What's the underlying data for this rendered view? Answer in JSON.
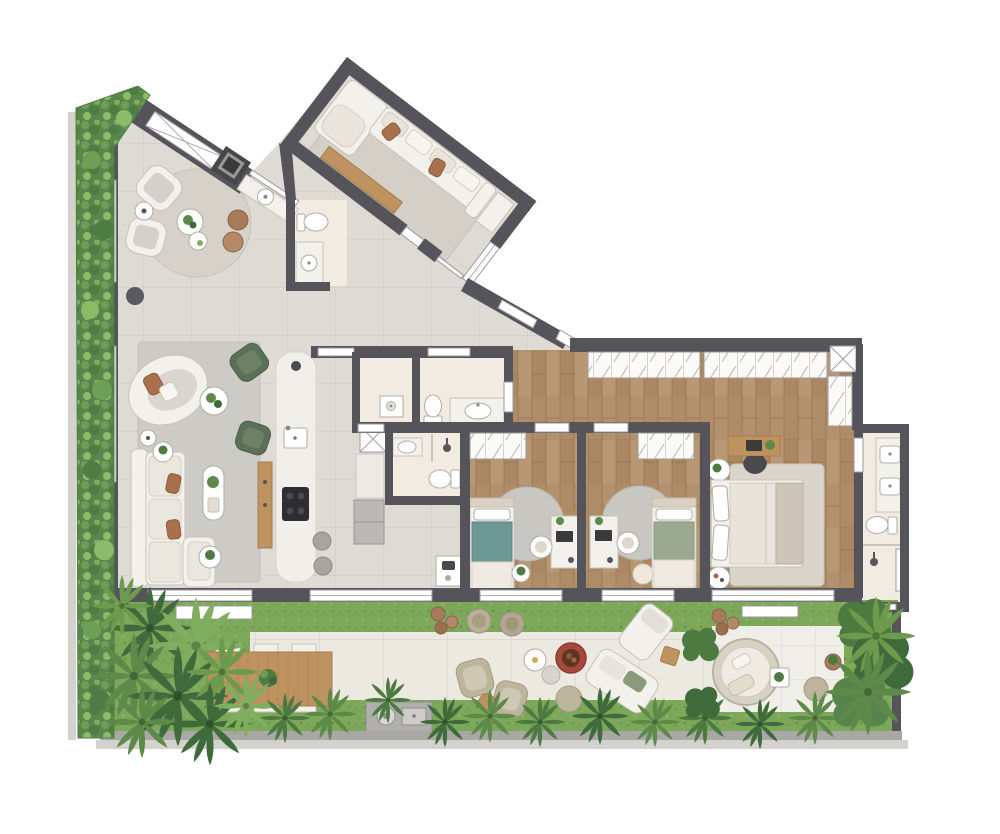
{
  "meta": {
    "type": "architectural-floor-plan",
    "style": "3d-rendered top-down marketing plan",
    "viewBox": "0 0 1000 834",
    "width": 1000,
    "height": 834
  },
  "colors": {
    "wall": "#55545a",
    "wallDark": "#45444a",
    "tile": "#dedbd4",
    "tileLine": "#ccc9c2",
    "wood": "#b3916e",
    "woodLine": "#9f7d58",
    "woodFurn": "#bf9360",
    "cream": "#f1ebe1",
    "furn": "#f3f1ec",
    "furnStroke": "#c8c3b9",
    "tan": "#bdb49c",
    "rugGray": "#cdcbc5",
    "rugBeige": "#d4d0c7",
    "greenChair": "#5c7058",
    "terracotta": "#b4643c",
    "teal": "#6e9894",
    "sage": "#9aa98f",
    "grass": "#7da85a",
    "grassDark": "#5e8a45",
    "paver": "#ece9e1",
    "paverLine": "#d9d5cb",
    "plantDark": "#3f6b3c",
    "plantMid": "#5d8a49",
    "plantLight": "#7fae5f",
    "hedge": "#59874b",
    "fire": "#a8473b",
    "steel": "#b0afac",
    "curb": "#d3d2ce",
    "curbDark": "#a9a8a5"
  },
  "rooms": [
    {
      "id": "entry-gallery",
      "furniture": [
        "pergola-skylight",
        "grill-station",
        "bar-sink"
      ]
    },
    {
      "id": "sitting-nook",
      "furniture": [
        "round-rug",
        "armchair",
        "armchair",
        "side-table",
        "nesting-tables",
        "pouf",
        "pouf",
        "floor-lamp"
      ]
    },
    {
      "id": "media-room",
      "furniture": [
        "sectional-sofa",
        "area-rug",
        "wood-console",
        "credenza"
      ]
    },
    {
      "id": "powder-room",
      "furniture": [
        "toilet",
        "vanity-sink"
      ]
    },
    {
      "id": "living-room",
      "furniture": [
        "curved-chaise",
        "l-sofa",
        "green-armchair",
        "green-armchair",
        "coffee-table",
        "oval-table",
        "side-table",
        "side-table",
        "floor-lamp",
        "wood-sideboard"
      ]
    },
    {
      "id": "kitchen",
      "furniture": [
        "island-counter",
        "cooktop",
        "island-sink",
        "stool",
        "stool",
        "tall-cabinet",
        "refrigerator",
        "service-shaft"
      ]
    },
    {
      "id": "laundry",
      "furniture": [
        "wash-tub"
      ]
    },
    {
      "id": "bathroom-1",
      "furniture": [
        "toilet",
        "vanity-sink"
      ]
    },
    {
      "id": "bathroom-2",
      "furniture": [
        "toilet",
        "vanity-sink",
        "shower"
      ]
    },
    {
      "id": "bedroom-1",
      "furniture": [
        "wardrobe",
        "single-bed",
        "round-rug",
        "desk",
        "desk-chair",
        "plant-table"
      ]
    },
    {
      "id": "bedroom-2",
      "furniture": [
        "wardrobe",
        "single-bed",
        "round-rug",
        "desk",
        "desk-chair",
        "pouf"
      ]
    },
    {
      "id": "suite-hall",
      "furniture": [
        "wardrobe-run",
        "wardrobe-run",
        "linen-closet",
        "service-shaft"
      ]
    },
    {
      "id": "master-bedroom",
      "furniture": [
        "double-bed",
        "nightstand",
        "nightstand",
        "desk",
        "desk-chair",
        "area-rug"
      ]
    },
    {
      "id": "master-bathroom",
      "furniture": [
        "double-vanity",
        "toilet",
        "shower"
      ]
    },
    {
      "id": "terrace",
      "furniture": [
        "outdoor-dining-table",
        "dining-chairs-6",
        "outdoor-sink-counter",
        "planter-bench",
        "planter-bench",
        "armchair",
        "armchair",
        "round-side-tables",
        "fire-pit",
        "poufs",
        "lounge-chaise",
        "outdoor-sofa",
        "nest-chair",
        "side-table",
        "pouf",
        "planter-pots"
      ]
    },
    {
      "id": "vertical-garden",
      "furniture": [
        "hedge"
      ]
    }
  ]
}
